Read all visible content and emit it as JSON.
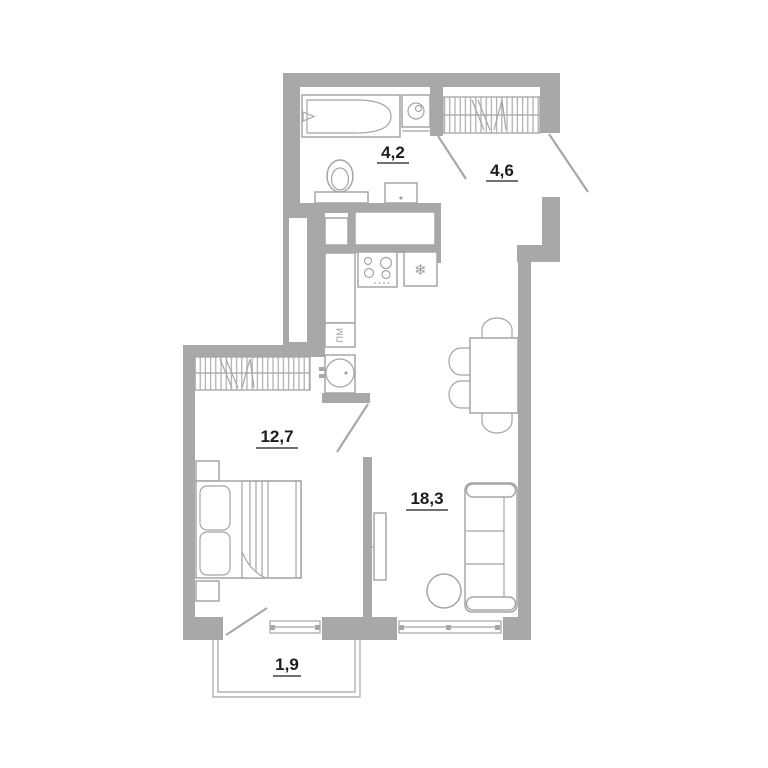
{
  "plan": {
    "type": "apartment-floor-plan",
    "rooms": {
      "bathroom": {
        "name": "bathroom",
        "area": "4,2"
      },
      "hallway": {
        "name": "hallway",
        "area": "4,6"
      },
      "bedroom": {
        "name": "bedroom",
        "area": "12,7"
      },
      "living_kitchen": {
        "name": "kitchen-living-room",
        "area": "18,3"
      },
      "balcony": {
        "name": "balcony",
        "area": "1,9"
      }
    },
    "appliances": {
      "dishwasher_label": "ПМ",
      "fridge_glyph": "❄"
    },
    "icons": [
      "bathtub-icon",
      "washing-machine-icon",
      "toilet-icon",
      "washbasin-icon",
      "wardrobe-icon",
      "stove-icon",
      "fridge-icon",
      "snowflake-icon",
      "kitchen-sink-icon",
      "dishwasher-icon",
      "dining-table-icon",
      "chair-icon",
      "sofa-icon",
      "pouf-icon",
      "tv-icon",
      "bed-icon",
      "nightstand-icon",
      "door-leaf-icon",
      "window-icon"
    ],
    "colors": {
      "wall": "#a8a8a8",
      "furniture_line": "#a5a5a5",
      "label_text": "#1c1c1c",
      "appliance_text": "#9c9c9c",
      "background": "#ffffff"
    }
  }
}
